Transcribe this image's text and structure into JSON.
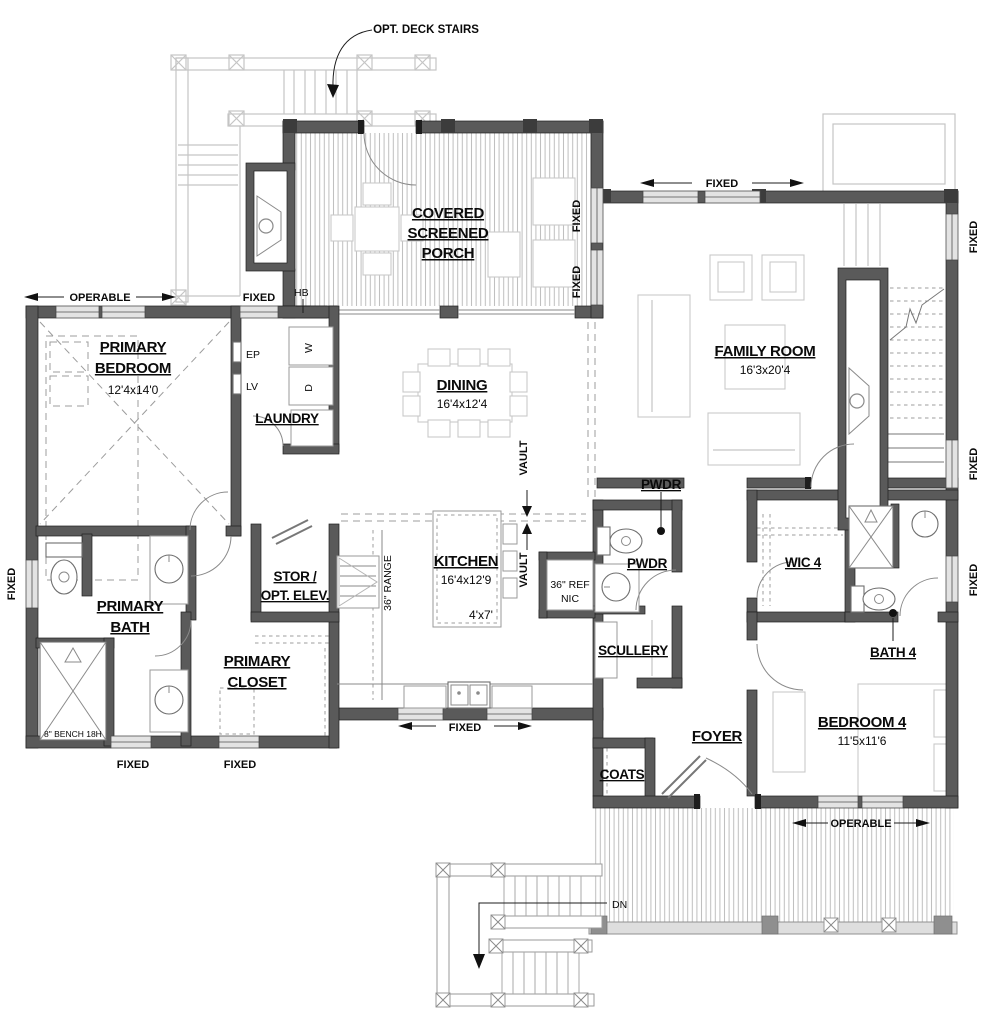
{
  "colors": {
    "background": "#ffffff",
    "ink": "#0a0a0a",
    "wall_poche": "#5a5a5a",
    "window_fill": "#e3e3e3",
    "ghost_line": "#c5c5c5",
    "deck_hatch": "#bdbdbd"
  },
  "annotations": {
    "opt_deck_stairs": "OPT. DECK STAIRS",
    "hb": "HB",
    "ep": "EP",
    "lv": "LV",
    "washer": "W",
    "dryer": "D",
    "range": "36\" RANGE",
    "dw": "DW",
    "tr": "TR",
    "ref1": "36\" REF",
    "ref2": "NIC",
    "vault": "VAULT",
    "bench": "8\" BENCH 18H",
    "dn": "DN"
  },
  "rooms": {
    "porch": {
      "l1": "COVERED",
      "l2": "SCREENED",
      "l3": "PORCH"
    },
    "family": {
      "name": "FAMILY ROOM",
      "dim": "16'3x20'4"
    },
    "primary_bedroom": {
      "l1": "PRIMARY",
      "l2": "BEDROOM",
      "dim": "12'4x14'0"
    },
    "laundry": {
      "name": "LAUNDRY"
    },
    "dining": {
      "name": "DINING",
      "dim": "16'4x12'4"
    },
    "kitchen": {
      "name": "KITCHEN",
      "dim": "16'4x12'9",
      "island": "4'x7'"
    },
    "pwdr": {
      "name": "PWDR"
    },
    "scullery": {
      "name": "SCULLERY"
    },
    "stor": {
      "l1": "STOR /",
      "l2": "OPT. ELEV."
    },
    "primary_bath": {
      "l1": "PRIMARY",
      "l2": "BATH"
    },
    "primary_closet": {
      "l1": "PRIMARY",
      "l2": "CLOSET"
    },
    "wic4": {
      "name": "WIC 4"
    },
    "bath4": {
      "name": "BATH 4"
    },
    "bedroom4": {
      "name": "BEDROOM 4",
      "dim": "11'5x11'6"
    },
    "foyer": {
      "name": "FOYER"
    },
    "coats": {
      "name": "COATS"
    }
  },
  "window_labels": {
    "operable_top": "OPERABLE",
    "fixed_laundry": "FIXED",
    "fixed_family_top": "FIXED",
    "fixed_porch_r1": "FIXED",
    "fixed_porch_r2": "FIXED",
    "fixed_right_top": "FIXED",
    "fixed_right_mid": "FIXED",
    "fixed_right_low": "FIXED",
    "fixed_left": "FIXED",
    "fixed_bottom_1": "FIXED",
    "fixed_bottom_2": "FIXED",
    "fixed_kitchen": "FIXED",
    "operable_bottom": "OPERABLE"
  }
}
